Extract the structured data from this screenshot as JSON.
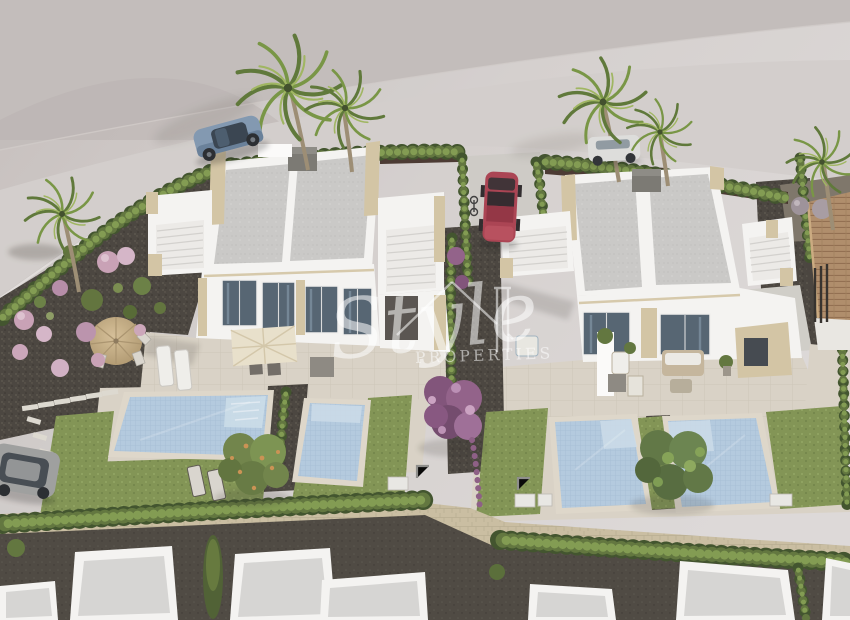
{
  "watermark": {
    "brand_script": "Style",
    "brand_caption": "PROPERTIES"
  },
  "palette": {
    "background_gray": "#cdc7c4",
    "road_gray": "#d4cfcc",
    "villa_white": "#f4f3f1",
    "roof_gray": "#c8c7c5",
    "stone_beige": "#d2c3a2",
    "window_glass": "#51606e",
    "pool_water": "#b1c8dd",
    "pool_steps": "#cadbe8",
    "lawn_green": "#7e9150",
    "hedge_green": "#5d7239",
    "gravel_dark": "#45403a",
    "paving_cream": "#d8d1c4",
    "boundary_wall_tan": "#c8bc9f",
    "street_dark": "#49443d",
    "terracotta_roof": "#ad8a66",
    "tree_purple": "#8a5a82",
    "flower_pink": "#c79fb4",
    "palm_green": "#6d8a41",
    "car_blue": "#7e95ae",
    "car_red": "#a83e4e",
    "car_white": "#dcdcda",
    "car_gray": "#9c9d9c",
    "watermark_white": "rgba(255,255,255,0.55)"
  },
  "scene": {
    "type": "aerial-3d-architectural-render",
    "villas": [
      "left-duplex-villa",
      "right-duplex-villa"
    ],
    "pools": 4,
    "palm_trees": 6,
    "vehicles": [
      "blue-coupe",
      "red-compact",
      "white-sedan",
      "gray-hatchback"
    ],
    "features": [
      "rooftop-solariums",
      "roof-access-stairs",
      "cypress-hedges",
      "purple-blossom-tree",
      "garden-umbrellas",
      "stepping-stones",
      "perimeter-stone-wall",
      "neighboring-tiled-roof-house"
    ]
  }
}
